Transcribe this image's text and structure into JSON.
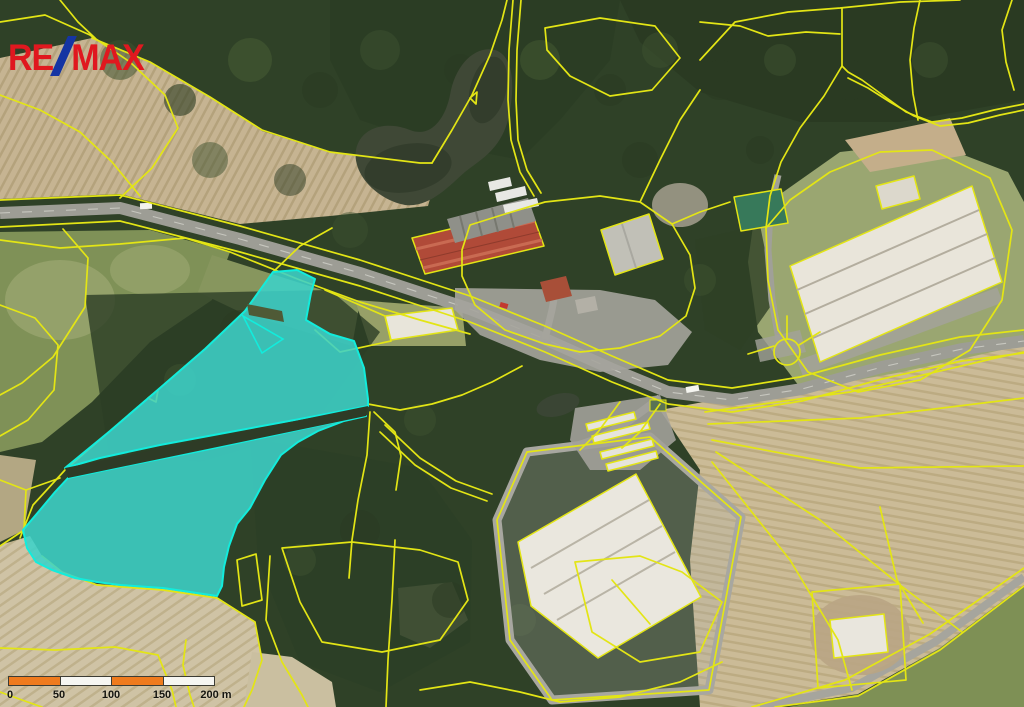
{
  "logo": {
    "text": "RE/MAX",
    "re": "RE",
    "slash": "/",
    "max": "MAX"
  },
  "scalebar": {
    "labels": [
      "0",
      "50",
      "100",
      "150",
      "200 m"
    ]
  },
  "colors": {
    "logo-red": "#e0181f",
    "logo-blue": "#1535a3",
    "cad-line": "#e3e515",
    "highlight-fill": "#3ed2c8",
    "highlight-stroke": "#12ecdc",
    "scale-orange": "#ef7b1e",
    "scale-white": "#f6f6f2"
  }
}
